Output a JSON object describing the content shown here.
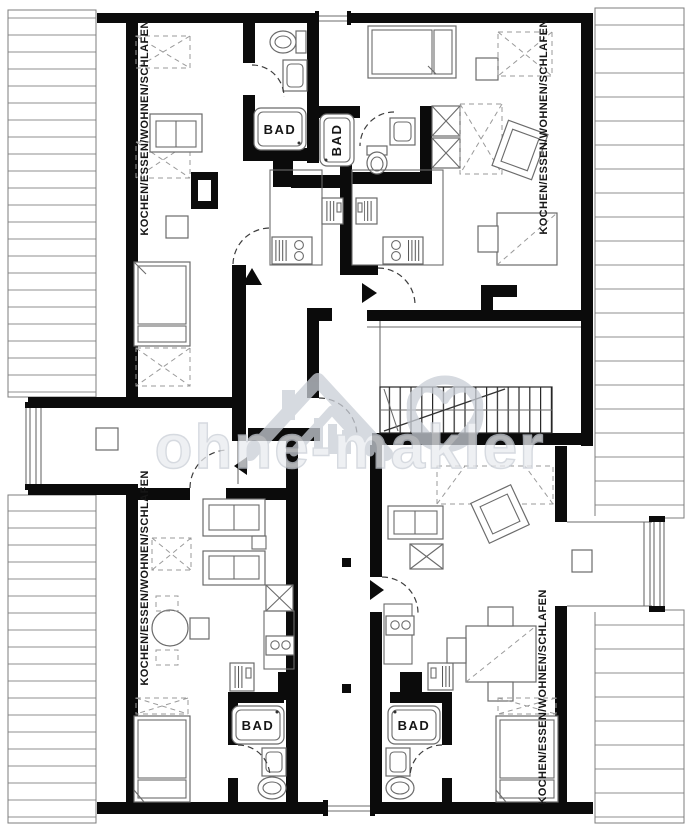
{
  "document": {
    "type": "floor-plan",
    "storey": "attic"
  },
  "watermark": {
    "text": "ohne-makler"
  },
  "labels": {
    "unit_top_left": "KOCHEN/ESSEN/WOHNEN/SCHLAFEN",
    "unit_top_right": "KOCHEN/ESSEN/WOHNEN/SCHLAFEN",
    "unit_bottom_left": "KOCHEN/ESSEN/WOHNEN/SCHLAFEN",
    "unit_bottom_right": "KOCHEN/ESSEN/WOHNEN/SCHLAFEN",
    "bath_top_left": "BAD",
    "bath_top_center": "BAD",
    "bath_bottom_left": "BAD",
    "bath_bottom_right": "BAD"
  },
  "colors": {
    "wall": "#0b0b0b",
    "hatch_line": "#8f8f8f",
    "hatch_border": "#7d7d7d",
    "furn_line": "#6b6b6b",
    "dash_line": "#9a9a9a",
    "door_line": "#3d3d3d",
    "label_color": "#161616",
    "wm_fill": "#e9ebef",
    "wm_stroke": "#c9ced6"
  }
}
